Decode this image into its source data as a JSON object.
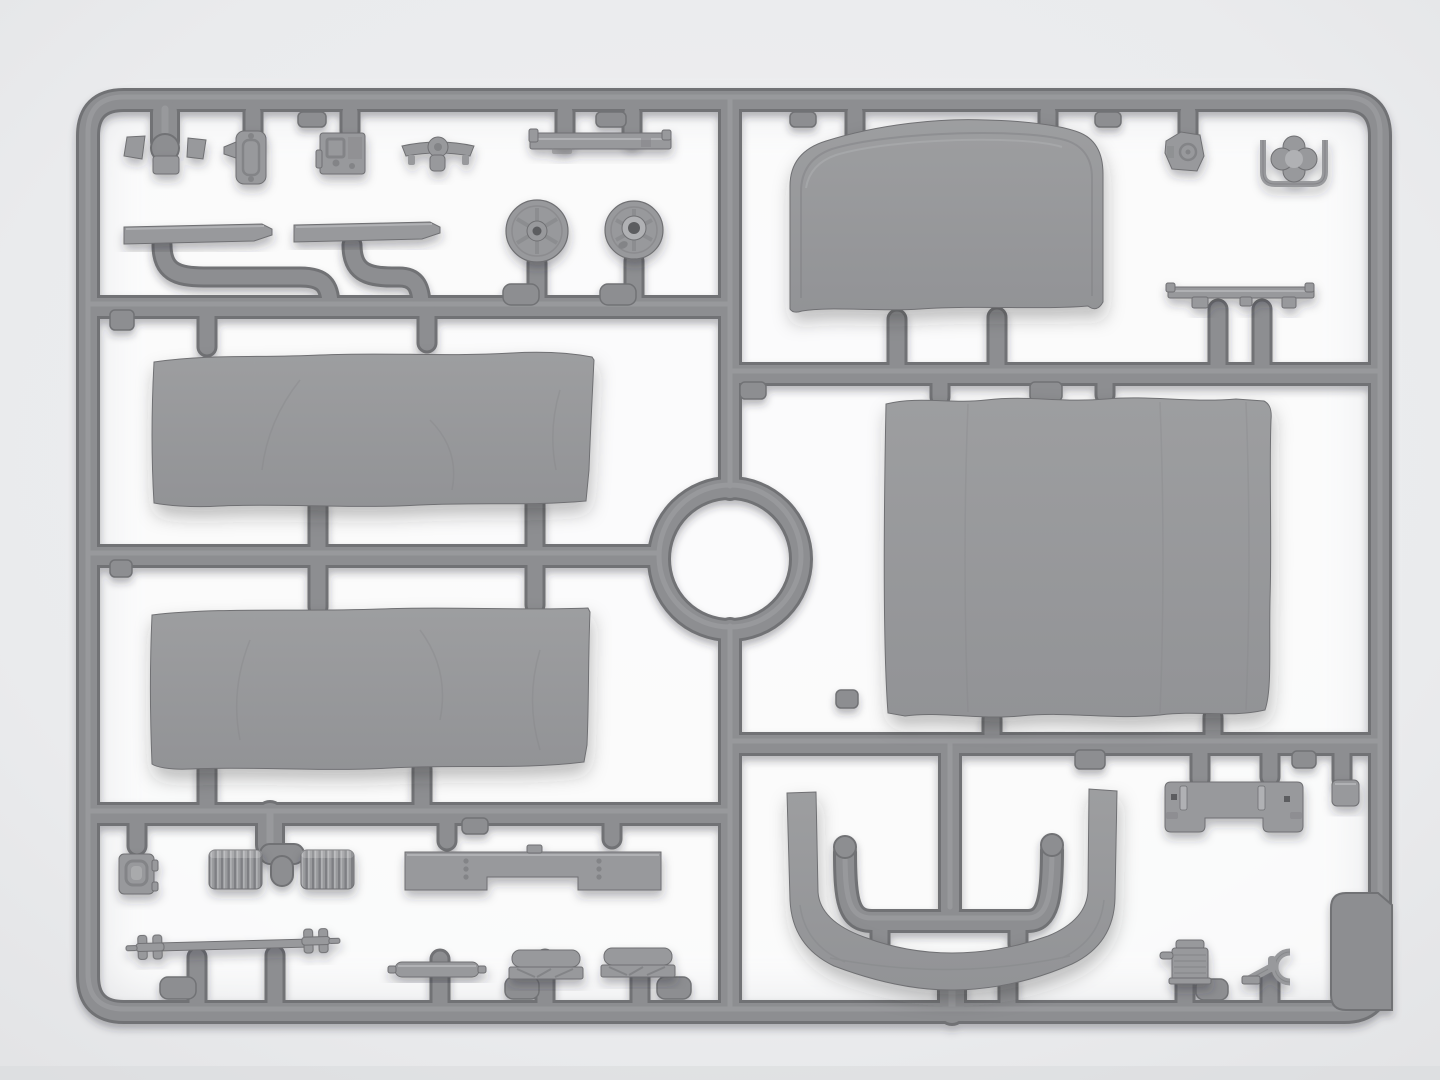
{
  "meta": {
    "scene": "gray-styrene-model-kit-sprue-photo",
    "visible_text": ""
  },
  "colors": {
    "bg-outer": "#e3e4e6",
    "bg-mid": "#efeff1",
    "glow": "#ffffff",
    "runner": "#8d8e91",
    "runner-dark": "#717275",
    "runner-light": "#a7a8ab",
    "part": "#98999c",
    "part-dark": "#838487",
    "part-edge": "#6f7073",
    "part-light": "#b0b1b4",
    "hole": "#5c5d60",
    "tarp-hi": "#9d9ea0",
    "tarp-lo": "#929396"
  },
  "sprue": {
    "frame": "rounded rectangular outer runner",
    "gates": [
      "vertical center divider",
      "circular pour gate ring",
      "three left cross runners",
      "two right cross runners",
      "anchor-shaped inner runner"
    ],
    "parts": [
      "wedge blocks pair",
      "shackle bracket",
      "gearbox block",
      "axle bracket",
      "channel rail",
      "tread plate left",
      "tread plate right",
      "spoked wheel solid hub",
      "spoked wheel open hub",
      "canvas tarp panel upper",
      "canvas tarp panel lower",
      "cab canvas top",
      "cargo bed canvas tarp",
      "windshield canvas cover U",
      "mount bracket small",
      "grab handle with clover knob",
      "ladder rail bracket",
      "air box",
      "corrugated hose left",
      "corrugated hose right",
      "tee gate",
      "front bumper crossmember",
      "drive shaft with u-joints",
      "exhaust pipe",
      "seat bench left",
      "seat bench right",
      "rear mount bracket",
      "cube block",
      "blank gate pad",
      "small radiator",
      "tow fork fitting"
    ]
  }
}
